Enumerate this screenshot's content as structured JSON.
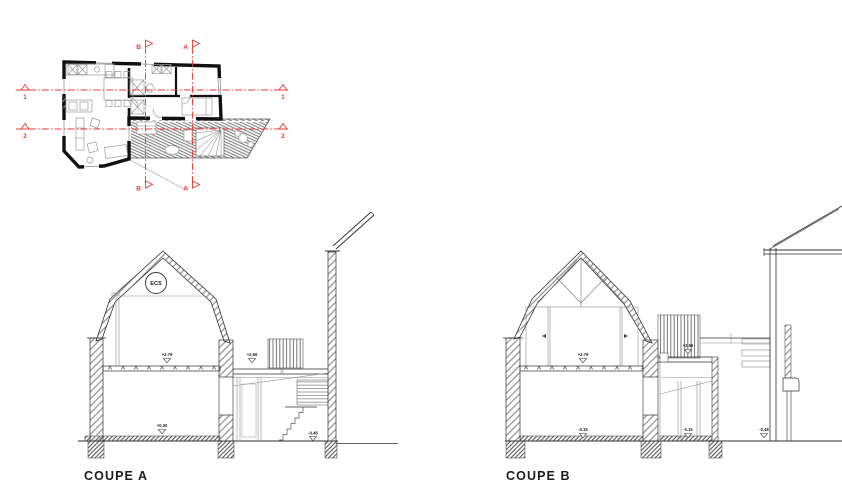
{
  "drawing_title": "House plan and cross sections",
  "colors": {
    "ink": "#2e2e2e",
    "hatch_gray": "#8f8f8f",
    "section_red": "#e8392e",
    "background": "#ffffff"
  },
  "plan": {
    "section_markers": {
      "b_top": "B",
      "a_top": "A",
      "b_bottom": "B",
      "a_bottom": "A",
      "line1_left": "1",
      "line1_right": "1",
      "line2_left": "2",
      "line2_right": "2"
    }
  },
  "coupe_a": {
    "title": "COUPE A",
    "ecs": "ECS",
    "levels": {
      "attic": "+2.79",
      "annex_roof": "+2.56",
      "ground": "+0.00",
      "street": "-0.48"
    }
  },
  "coupe_b": {
    "title": "COUPE B",
    "levels": {
      "attic": "+2.79",
      "annex_roof": "+2.56",
      "ground_left": "-0.15",
      "ground_right": "-0.15",
      "street": "-0.48"
    }
  }
}
